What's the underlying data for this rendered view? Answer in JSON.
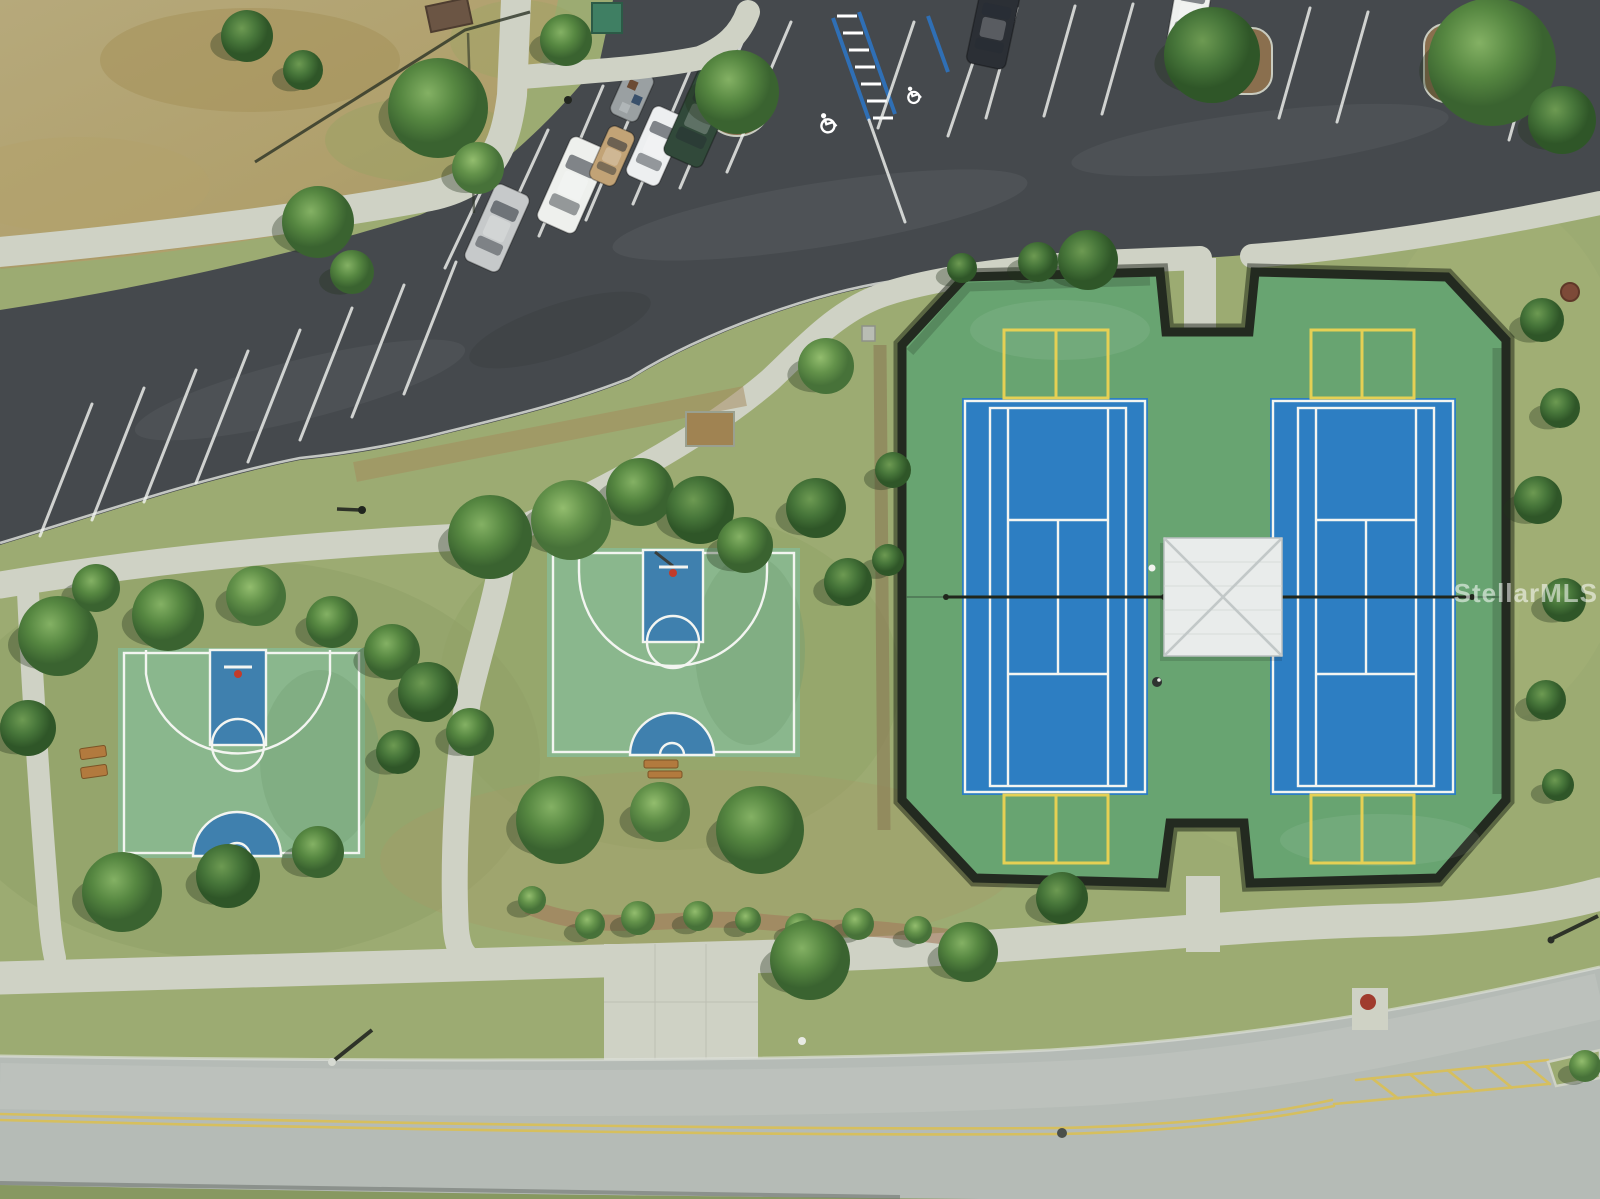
{
  "watermark": {
    "text": "StellarMLS"
  },
  "palette": {
    "lawn": "#9cab72",
    "lawnL": "#a9b77d",
    "lawnD": "#879861",
    "field": "#b4a577",
    "fieldD": "#a3925e",
    "fieldG": "#9aa367",
    "asphalt": "#45494d",
    "asphaltL": "#565a5d",
    "road": "#b5bbb6",
    "roadL": "#c7ccc6",
    "curbShadow": "#6f746e",
    "walk": "#cfd2c5",
    "walkD": "#bcc0b2",
    "courtGreen": "#68a471",
    "courtBlue": "#2d7ec2",
    "bbGreen": "#8ab78d",
    "bbBlue": "#3f80ae",
    "white": "#f3f5f1",
    "pbYellow": "#e5d054",
    "roadYellow": "#d6bf5e",
    "fence": "#232a20",
    "roof": "#e9eceb",
    "roofRidge": "#c2c8c8",
    "mulch": "#9c8259",
    "mulchR": "#a3795c",
    "bench": "#b27a3e",
    "net": "#20261c",
    "hcBlue": "#2f6fb5",
    "hydrant": "#a03c2e",
    "manhole": "#7d4a38"
  },
  "scene": {
    "description": "Aerial drone view of a community park: parking lot, two fenced tennis/pickleball courts with center pavilion, two half basketball courts, curving road and sidewalks",
    "parking_lot": {
      "accessible_spaces": 2,
      "accessible_marking": "blue hatched access aisle with white wheelchair symbols",
      "cars": [
        {
          "type": "sedan",
          "label": "silver sedan",
          "color": "#c6c9ca"
        },
        {
          "type": "suv",
          "label": "white SUV",
          "color": "#eef0ed"
        },
        {
          "type": "pickup",
          "label": "tan pickup",
          "color": "#c2a376"
        },
        {
          "type": "sedan",
          "label": "white sedan",
          "color": "#edeff0"
        },
        {
          "type": "suv",
          "label": "dark green SUV",
          "color": "#31493a"
        },
        {
          "type": "trailer",
          "label": "utility trailer with gear",
          "color": "#9aa0a2"
        },
        {
          "type": "suv",
          "label": "black SUV",
          "color": "#2b2f35"
        },
        {
          "type": "sedan",
          "label": "white car",
          "color": "#eef0ed"
        }
      ]
    },
    "tennis_complex": {
      "tennis_courts": 2,
      "pickleball_courts": 4,
      "surface": "green apron with blue court pads",
      "line_colors": [
        "white",
        "yellow"
      ],
      "pavilion": "white hip roof shelter at center",
      "fence": "black chain-link perimeter with north and south gate notches"
    },
    "basketball_courts": {
      "count": 2,
      "surface": "green with blue painted key",
      "benches": 3
    },
    "road": {
      "marking": "double yellow centerline with hatched median wedge",
      "lanes": 2
    },
    "landscape": {
      "field": "dry tan grass field (northwest)",
      "trees": "scattered canopy trees and hedge rows"
    }
  }
}
